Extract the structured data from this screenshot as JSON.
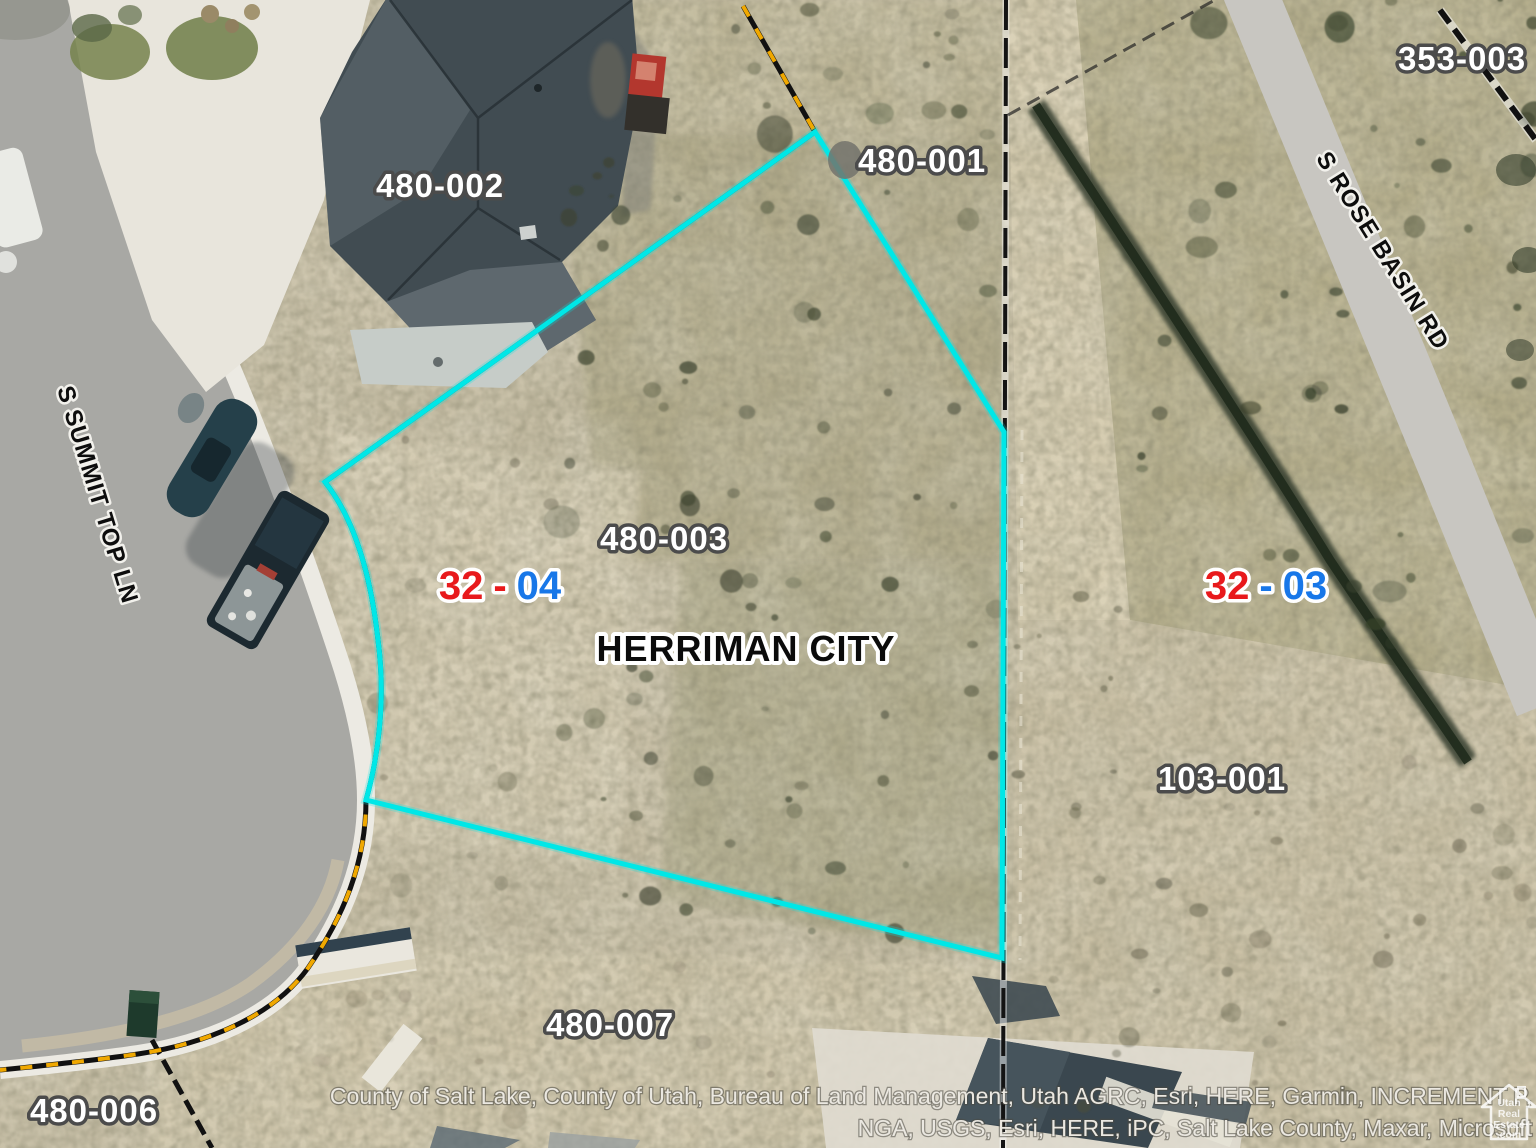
{
  "map": {
    "city": "HERRIMAN CITY",
    "parcels": [
      {
        "id": "480-002"
      },
      {
        "id": "480-001"
      },
      {
        "id": "480-003"
      },
      {
        "id": "353-003"
      },
      {
        "id": "103-001"
      },
      {
        "id": "480-007"
      },
      {
        "id": "480-006"
      }
    ],
    "sections": [
      {
        "book": "32",
        "sep": "-",
        "page": "04"
      },
      {
        "book": "32",
        "sep": "-",
        "page": "03"
      }
    ],
    "streets": [
      {
        "name": "S SUMMIT TOP LN"
      },
      {
        "name": "S ROSE BASIN RD"
      }
    ],
    "attribution": {
      "line1": "County of Salt Lake, County of Utah, Bureau of Land Management, Utah AGRC, Esri, HERE, Garmin, INCREMENT P,",
      "line2": "NGA, USGS, Esri, HERE, iPC, Salt Lake County, Maxar, Microsoft"
    },
    "watermark": {
      "line1": "Utah",
      "line2": "Real",
      "line3": "Estate",
      "line4": ".com"
    },
    "colors": {
      "highlight": "#00e7e7",
      "section_red": "#e8191c",
      "section_blue": "#1877e8",
      "parcel_label_fill": "#ffffff",
      "parcel_label_outline": "#4b4b4b",
      "city_label": "#0b0b0b",
      "boundary_yellow": "#f0a800",
      "boundary_black": "#141414"
    }
  }
}
